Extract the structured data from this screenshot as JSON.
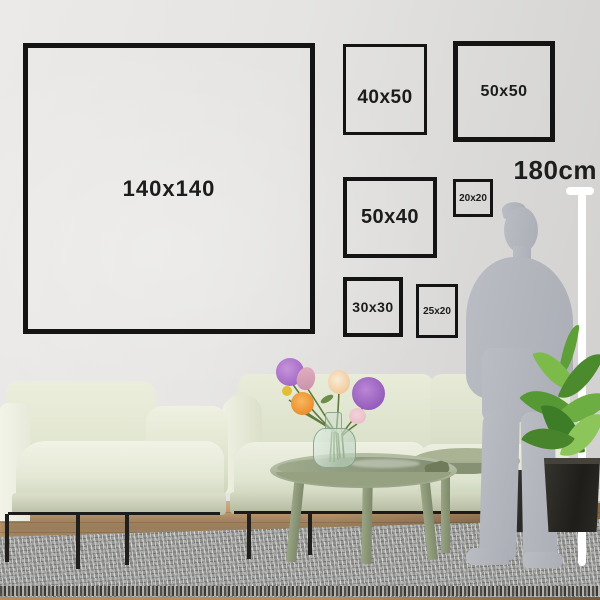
{
  "meta": {
    "description": "Wall art size guide: labeled picture frame sizes on a living room wall with a 180cm human silhouette for scale"
  },
  "frames": [
    {
      "id": "140x140",
      "label": "140x140"
    },
    {
      "id": "40x50",
      "label": "40x50"
    },
    {
      "id": "50x50",
      "label": "50x50"
    },
    {
      "id": "50x40",
      "label": "50x40"
    },
    {
      "id": "20x20",
      "label": "20x20"
    },
    {
      "id": "30x30",
      "label": "30x30"
    },
    {
      "id": "25x20",
      "label": "25x20"
    }
  ],
  "scale_reference": {
    "height_label": "180cm"
  },
  "colors": {
    "frame_border": "#141414",
    "label_text": "#1c1c1c",
    "wall": "#e3e2e0",
    "sofa_fabric": "#e4e8d5",
    "table_green": "#a2ad8c",
    "rug_gray": "#a1a19f",
    "silhouette_gray": "#b4b7bd",
    "ruler_white": "#ffffff",
    "plant_green": "#569934",
    "pot_black": "#26241f",
    "floor_wood": "#c49b6b",
    "flower_purple": "#a167c4",
    "flower_orange": "#ec9231",
    "flower_pink": "#e3b1c2",
    "flower_yellow": "#e2be34"
  }
}
